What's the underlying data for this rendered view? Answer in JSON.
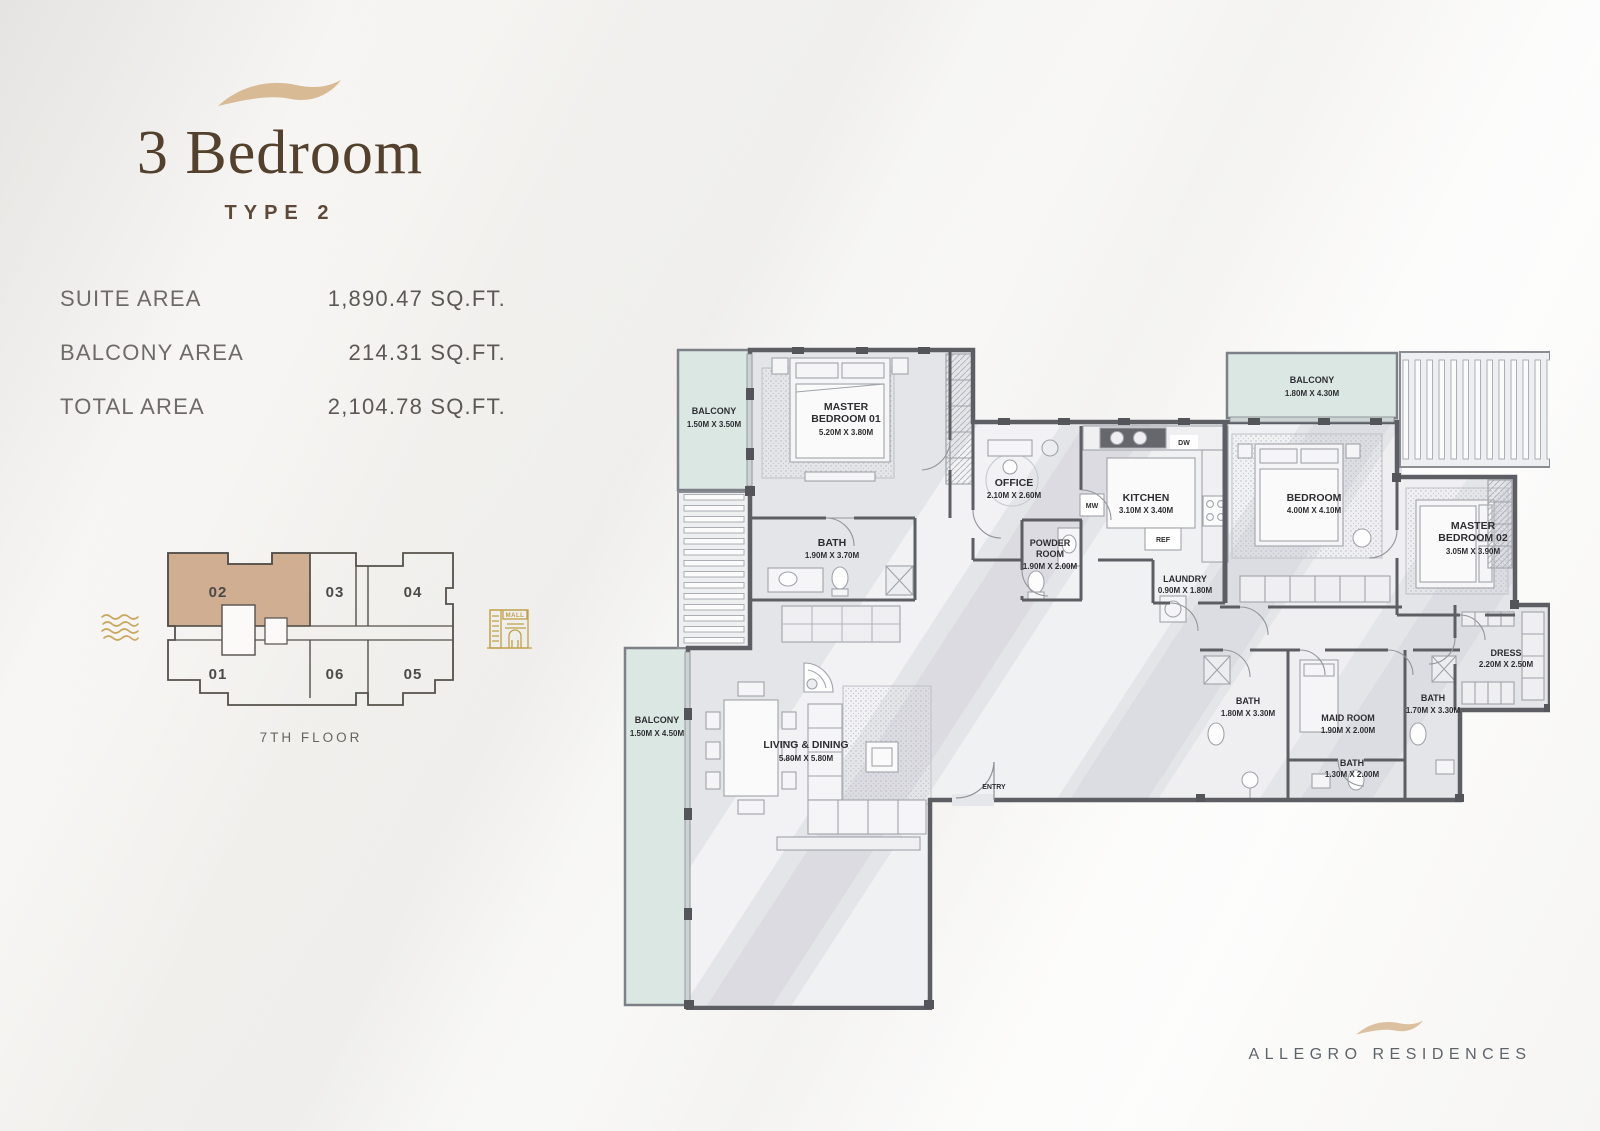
{
  "brand": {
    "name": "ALLEGRO RESIDENCES",
    "swoosh_color": "#d8ba94"
  },
  "unit": {
    "title": "3 Bedroom",
    "type": "TYPE 2",
    "areas": [
      {
        "label": "SUITE AREA",
        "value": "1,890.47 SQ.FT."
      },
      {
        "label": "BALCONY AREA",
        "value": "214.31 SQ.FT."
      },
      {
        "label": "TOTAL AREA",
        "value": "2,104.78 SQ.FT."
      }
    ]
  },
  "key_plan": {
    "floor": "7TH FLOOR",
    "highlighted_unit": "02",
    "highlight_color": "#cfae92",
    "mall_label": "MALL",
    "units": [
      {
        "label": "02"
      },
      {
        "label": "03"
      },
      {
        "label": "04"
      },
      {
        "label": "01"
      },
      {
        "label": "06"
      },
      {
        "label": "05"
      }
    ]
  },
  "floor_plan": {
    "appliances": {
      "dw": "DW",
      "mw": "MW",
      "ref": "REF"
    },
    "rooms": [
      {
        "id": "balcony-top-left",
        "lines": [
          "BALCONY"
        ],
        "dims": "1.50M X 3.50M"
      },
      {
        "id": "master-bedroom-01",
        "lines": [
          "MASTER",
          "BEDROOM 01"
        ],
        "dims": "5.20M X 3.80M"
      },
      {
        "id": "bath-master-01",
        "lines": [
          "BATH"
        ],
        "dims": "1.90M X 3.70M"
      },
      {
        "id": "office",
        "lines": [
          "OFFICE"
        ],
        "dims": "2.10M X 2.60M"
      },
      {
        "id": "kitchen",
        "lines": [
          "KITCHEN"
        ],
        "dims": "3.10M X 3.40M"
      },
      {
        "id": "powder-room",
        "lines": [
          "POWDER",
          "ROOM"
        ],
        "dims": "1.90M X 2.00M"
      },
      {
        "id": "laundry",
        "lines": [
          "LAUNDRY"
        ],
        "dims": "0.90M X 1.80M"
      },
      {
        "id": "balcony-top-right",
        "lines": [
          "BALCONY"
        ],
        "dims": "1.80M X 4.30M"
      },
      {
        "id": "bedroom",
        "lines": [
          "BEDROOM"
        ],
        "dims": "4.00M X 4.10M"
      },
      {
        "id": "master-bedroom-02",
        "lines": [
          "MASTER",
          "BEDROOM 02"
        ],
        "dims": "3.05M X 3.90M"
      },
      {
        "id": "dress",
        "lines": [
          "DRESS"
        ],
        "dims": "2.20M X 2.50M"
      },
      {
        "id": "bath-2",
        "lines": [
          "BATH"
        ],
        "dims": "1.80M X 3.30M"
      },
      {
        "id": "maid-room",
        "lines": [
          "MAID ROOM"
        ],
        "dims": "1.90M X 2.00M"
      },
      {
        "id": "bath-3",
        "lines": [
          "BATH"
        ],
        "dims": "1.70M X 3.30M"
      },
      {
        "id": "bath-4",
        "lines": [
          "BATH"
        ],
        "dims": "1.30M X 2.00M"
      },
      {
        "id": "living-dining",
        "lines": [
          "LIVING & DINING"
        ],
        "dims": "5.80M X 5.80M"
      },
      {
        "id": "balcony-bottom-left",
        "lines": [
          "BALCONY"
        ],
        "dims": "1.50M X 4.50M"
      },
      {
        "id": "entry",
        "lines": [
          "ENTRY"
        ],
        "dims": ""
      }
    ]
  }
}
